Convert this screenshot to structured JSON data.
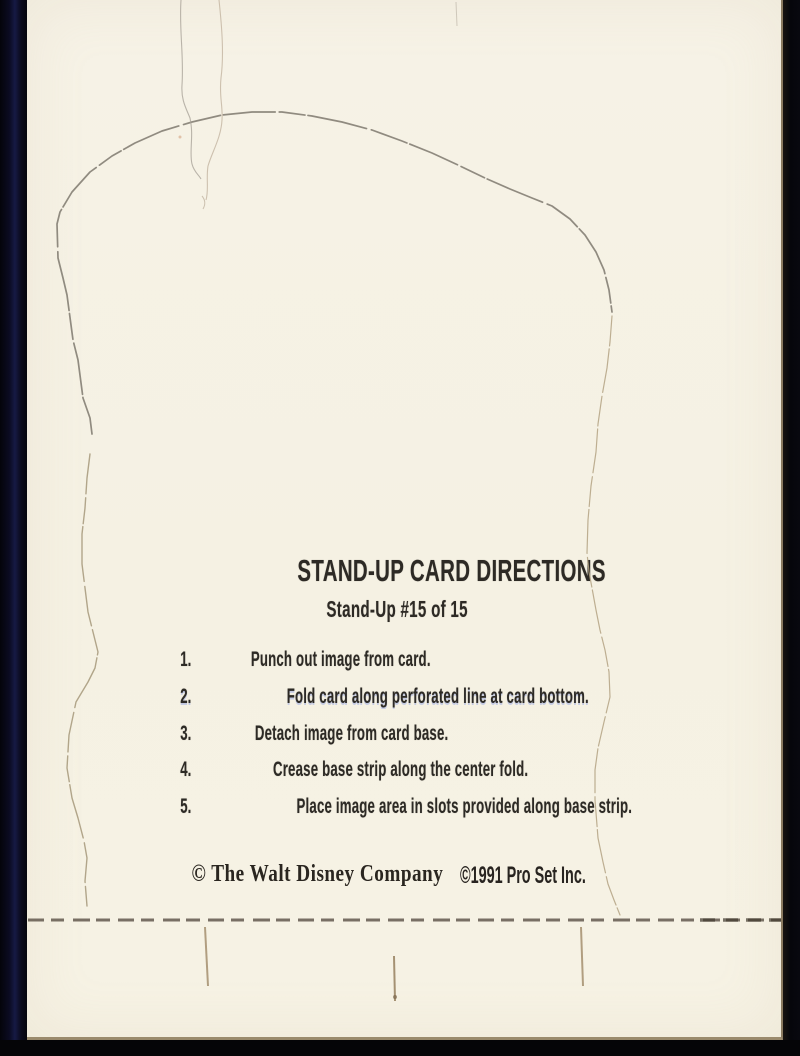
{
  "card": {
    "title": "STAND-UP CARD DIRECTIONS",
    "subtitle": "Stand-Up #15 of 15",
    "directions": [
      {
        "num": "1.",
        "text": "Punch out image from card."
      },
      {
        "num": "2.",
        "text": "Fold card along perforated line at card bottom."
      },
      {
        "num": "3.",
        "text": "Detach image from card base."
      },
      {
        "num": "4.",
        "text": "Crease base strip along the center fold."
      },
      {
        "num": "5.",
        "text": "Place image area in slots provided along base strip."
      }
    ],
    "copyright": {
      "disney": "© The Walt Disney Company",
      "proset": "©1991 Pro Set Inc."
    }
  },
  "colors": {
    "paper": "#f5f1e4",
    "ink": "#2d2a25",
    "scan_border_navy": "#161a44",
    "scan_border_black": "#06060b",
    "die_line_gray": "#857f74",
    "die_line_tan": "#b0a084",
    "perforation_dash": "#5d5348",
    "slot_mark": "#a5906f"
  }
}
